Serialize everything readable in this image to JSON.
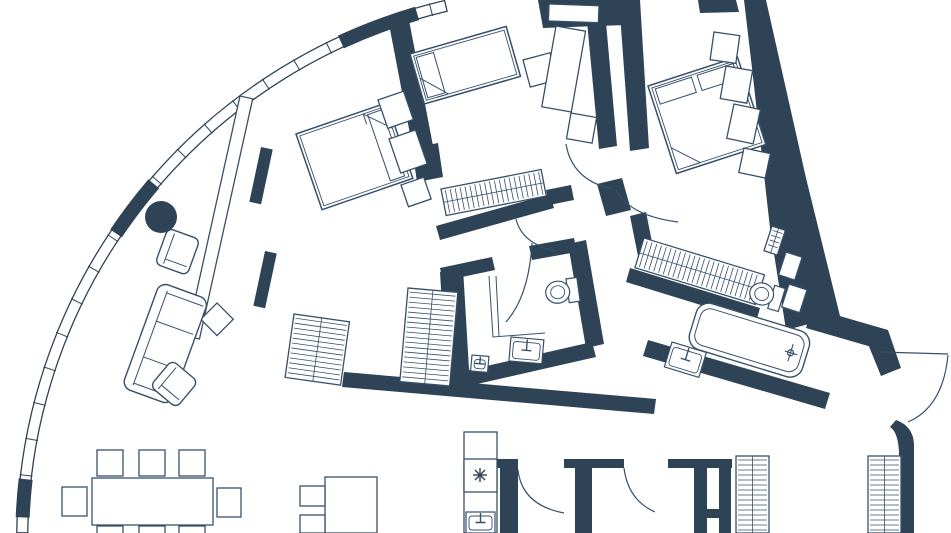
{
  "meta": {
    "title": "apartment-floor-plan",
    "canvas": {
      "width": 951,
      "height": 533
    },
    "colors": {
      "wall": "#2e4356",
      "line": "#37506a",
      "bg": "#ffffff"
    }
  },
  "floor_plan": {
    "window_wall": {
      "cx": 571.2,
      "cy": 540.4,
      "r_outer": 554.5,
      "r_inner": 543.5,
      "theta_start": -179.2,
      "theta_end": -103.2,
      "tick_step": 3.8,
      "solid_segments": [
        [
          -177.6,
          -173.6
        ],
        [
          -146.0,
          -139.5
        ],
        [
          -114.8,
          -106.3
        ]
      ],
      "column": {
        "cx": 161,
        "cy": 217,
        "r": 16
      }
    },
    "walls": [
      {
        "name": "wall-entry-top",
        "points": "538,0 622,0 626,25 543,28"
      },
      {
        "name": "wall-entry-top-2",
        "points": "698,0 736,0 739,12 700,13"
      },
      {
        "name": "wall-divider-left",
        "points": "389,24 409,20 438,172 418,176"
      },
      {
        "name": "wall-divider-left-foot",
        "points": "412,148 438,143 443,177 417,182"
      },
      {
        "name": "wall-divider-right",
        "points": "585,0 604,0 617,146 599,149"
      },
      {
        "name": "wall-hall-junction",
        "points": "597,184 622,178 631,210 606,216"
      },
      {
        "name": "wall-centerroom-south",
        "points": "436,226 550,194 554,208 440,240"
      },
      {
        "name": "wall-centerbath-top-left",
        "points": "440,268 492,257 495,270 443,281"
      },
      {
        "name": "wall-centerbath-top-right",
        "points": "529,246 574,238 577,252 532,260"
      },
      {
        "name": "wall-centerbath-stub",
        "points": "546,190 571,185 574,200 549,205"
      },
      {
        "name": "wall-centerbath-left",
        "points": "440,272 463,268 470,386 447,389"
      },
      {
        "name": "wall-centerbath-right",
        "points": "568,244 586,240 604,344 586,348"
      },
      {
        "name": "wall-centerbath-bottom",
        "points": "460,372 592,342 596,357 464,387"
      },
      {
        "name": "wall-living-kitchen",
        "points": "344,372 656,399 654,414 342,387"
      },
      {
        "name": "wall-rightbath-bottom",
        "points": "648,340 830,393 825,409 643,356"
      },
      {
        "name": "wall-rightbath-left",
        "points": "630,216 646,212 656,262 640,266"
      },
      {
        "name": "wall-rightroom-wardrobe-base",
        "points": "630,268 760,308 756,322 626,282"
      },
      {
        "name": "wall-exterior-right",
        "points": "744,0 766,0 806,178 840,316 786,330 770,228 752,68"
      },
      {
        "name": "wall-bend",
        "points": "812,308 888,330 882,350 806,328"
      },
      {
        "name": "wall-step",
        "points": "868,344 888,330 901,368 881,376"
      },
      {
        "name": "wall-rightroom-left",
        "points": "619,0 640,0 649,148 630,151"
      }
    ],
    "wall_paths": [
      {
        "name": "wall-pier-a",
        "d": "M488,459 L518,459 L518,533 L500,533 L500,468 L488,468 Z"
      },
      {
        "name": "wall-pier-b",
        "d": "M564,459 L624,459 L624,468 L592,468 L592,533 L575,533 L575,468 L564,468 Z"
      },
      {
        "name": "wall-pier-c-top",
        "d": "M668,459 L732,459 L732,468 L668,468 Z"
      },
      {
        "name": "wall-pier-c-leg-left",
        "d": "M694,468 L707,468 L707,533 L694,533 Z"
      },
      {
        "name": "wall-pier-c-leg-right",
        "d": "M719,468 L731,468 L731,533 L719,533 Z"
      },
      {
        "name": "wall-pier-c-shelf",
        "d": "M694,509 L731,509 L731,518 L694,518 Z"
      },
      {
        "name": "wall-right-bottom",
        "d": "M896,420 Q913,426 914,444 L914,533 L899,533 L899,452 Q898,432 890,427 Z"
      }
    ],
    "solid_rects": [
      {
        "name": "radiator-1",
        "x": 261,
        "y": 147,
        "rot": 12,
        "w": 12,
        "h": 56
      },
      {
        "name": "radiator-2",
        "x": 265,
        "y": 251,
        "rot": 12,
        "w": 12,
        "h": 56
      }
    ],
    "partitions": [
      {
        "name": "partition-living",
        "x": 240,
        "y": 96,
        "rot": 12.5,
        "w": 13,
        "h": 246
      }
    ],
    "doors": [
      {
        "name": "door-arc-center-bedroom",
        "d": "M566,144 Q572,180 612,189"
      },
      {
        "name": "door-arc-right-bedroom",
        "d": "M616,190 Q630,216 678,222"
      },
      {
        "name": "door-arc-centerbath-lobby",
        "d": "M516,219 Q522,244 556,251"
      },
      {
        "name": "door-arc-centerbath",
        "d": "M532,243 Q529,296 506,322"
      },
      {
        "name": "door-arc-corridor-1",
        "d": "M518,470 Q522,505 564,513"
      },
      {
        "name": "door-arc-corridor-2",
        "d": "M624,468 Q628,500 655,512"
      },
      {
        "name": "door-leaf-terrace",
        "d": "M880,352 L948,354"
      },
      {
        "name": "door-arc-terrace",
        "d": "M948,355 Q943,407 908,422"
      }
    ],
    "thin_lines": [
      {
        "name": "centerbath-screen-1",
        "d": "M489,276 L493,337 L545,333"
      },
      {
        "name": "centerbath-screen-2",
        "d": "M496,276 L499,336"
      },
      {
        "name": "desk-bottom-divider",
        "d": "M351,477 L351,533"
      }
    ],
    "wardrobes": [
      {
        "name": "wardrobe-left-low",
        "x": 294,
        "y": 314,
        "rot": 8,
        "w": 56,
        "h": 64,
        "tick": "h"
      },
      {
        "name": "wardrobe-column",
        "x": 408,
        "y": 288,
        "rot": 5,
        "w": 50,
        "h": 94,
        "tick": "h"
      },
      {
        "name": "wardrobe-center-room",
        "x": 441,
        "y": 189,
        "rot": -11,
        "w": 102,
        "h": 27,
        "tick": "v"
      },
      {
        "name": "wardrobe-right-room",
        "x": 644,
        "y": 238,
        "rot": 17,
        "w": 126,
        "h": 31,
        "tick": "v"
      },
      {
        "name": "wardrobe-hall-1",
        "x": 736,
        "y": 456,
        "rot": 0,
        "w": 33,
        "h": 77,
        "tick": "h"
      },
      {
        "name": "wardrobe-hall-2",
        "x": 868,
        "y": 456,
        "rot": 0,
        "w": 33,
        "h": 77,
        "tick": "h"
      },
      {
        "name": "shaft-hatch",
        "x": 772,
        "y": 226,
        "rot": 18,
        "w": 14,
        "h": 26,
        "tick": "h"
      }
    ],
    "beds": [
      {
        "name": "bed-left",
        "x": 296,
        "y": 134,
        "rot": -19,
        "w": 96,
        "h": 80,
        "pillow": "right",
        "fold": "tr"
      },
      {
        "name": "bed-center",
        "x": 410,
        "y": 54,
        "rot": -16,
        "w": 100,
        "h": 52,
        "pillow": "left",
        "fold": "bl"
      },
      {
        "name": "bed-right",
        "x": 648,
        "y": 86,
        "rot": -18,
        "w": 94,
        "h": 92,
        "pillow": "top",
        "fold": "bl"
      }
    ],
    "rects": [
      {
        "name": "nightstand-left-1",
        "x": 378,
        "y": 100,
        "rot": -19,
        "w": 27,
        "h": 30
      },
      {
        "name": "nightstand-left-2",
        "x": 389,
        "y": 139,
        "rot": -19,
        "w": 28,
        "h": 36
      },
      {
        "name": "nightstand-left-3",
        "x": 401,
        "y": 185,
        "rot": -19,
        "w": 24,
        "h": 23
      },
      {
        "name": "side-table-center",
        "x": 523,
        "y": 60,
        "rot": -15,
        "w": 28,
        "h": 28
      },
      {
        "name": "desk-center",
        "x": 556,
        "y": 26,
        "rot": 10,
        "w": 30,
        "h": 82
      },
      {
        "name": "desk-chair-center",
        "x": 571,
        "y": 113,
        "rot": 10,
        "w": 26,
        "h": 26
      },
      {
        "name": "nightstand-right-1",
        "x": 714,
        "y": 32,
        "rot": 8,
        "w": 26,
        "h": 28
      },
      {
        "name": "nightstand-right-2",
        "x": 726,
        "y": 66,
        "rot": 10,
        "w": 27,
        "h": 33
      },
      {
        "name": "nightstand-right-3",
        "x": 734,
        "y": 104,
        "rot": 12,
        "w": 27,
        "h": 35
      },
      {
        "name": "nightstand-right-4",
        "x": 744,
        "y": 148,
        "rot": 12,
        "w": 27,
        "h": 25
      },
      {
        "name": "coffee-table",
        "x": 217,
        "y": 303,
        "rot": 45,
        "w": 23,
        "h": 23
      },
      {
        "name": "dining-table",
        "x": 92,
        "y": 478,
        "rot": 0,
        "w": 121,
        "h": 47
      },
      {
        "name": "dining-chair-1",
        "x": 97,
        "y": 450,
        "rot": 0,
        "w": 26,
        "h": 26
      },
      {
        "name": "dining-chair-2",
        "x": 139,
        "y": 450,
        "rot": 0,
        "w": 26,
        "h": 26
      },
      {
        "name": "dining-chair-3",
        "x": 179,
        "y": 450,
        "rot": 0,
        "w": 26,
        "h": 26
      },
      {
        "name": "dining-chair-4",
        "x": 62,
        "y": 487,
        "rot": 0,
        "w": 25,
        "h": 29
      },
      {
        "name": "dining-chair-5",
        "x": 217,
        "y": 488,
        "rot": 0,
        "w": 24,
        "h": 29
      },
      {
        "name": "dining-chair-6",
        "x": 97,
        "y": 526,
        "rot": 0,
        "w": 26,
        "h": 20
      },
      {
        "name": "dining-chair-7",
        "x": 139,
        "y": 526,
        "rot": 0,
        "w": 26,
        "h": 20
      },
      {
        "name": "dining-chair-8",
        "x": 179,
        "y": 526,
        "rot": 0,
        "w": 26,
        "h": 20
      },
      {
        "name": "desk-bottom",
        "x": 325,
        "y": 477,
        "rot": 0,
        "w": 52,
        "h": 56
      },
      {
        "name": "desk-bottom-chair-1",
        "x": 300,
        "y": 486,
        "rot": 0,
        "w": 25,
        "h": 20
      },
      {
        "name": "desk-bottom-chair-2",
        "x": 300,
        "y": 515,
        "rot": 0,
        "w": 25,
        "h": 18
      },
      {
        "name": "kitchen-counter",
        "x": 464,
        "y": 432,
        "rot": 0,
        "w": 33,
        "h": 101
      },
      {
        "name": "fridge",
        "x": 464,
        "y": 459,
        "rot": 0,
        "w": 33,
        "h": 33
      },
      {
        "name": "niche-square-1",
        "x": 786,
        "y": 252,
        "rot": 18,
        "w": 17,
        "h": 24
      },
      {
        "name": "niche-square-2",
        "x": 789,
        "y": 284,
        "rot": 18,
        "w": 19,
        "h": 24
      },
      {
        "name": "entry-door-leaf",
        "x": 549,
        "y": 4,
        "rot": 2,
        "w": 50,
        "h": 17
      }
    ],
    "sofa": {
      "name": "sofa",
      "x": 160,
      "y": 282,
      "rot": 20,
      "w": 52,
      "h": 112
    },
    "armchairs": [
      {
        "name": "armchair-1",
        "x": 168,
        "y": 228,
        "rot": 20,
        "w": 34,
        "h": 38
      },
      {
        "name": "armchair-2",
        "x": 172,
        "y": 360,
        "rot": 40,
        "w": 34,
        "h": 34
      }
    ],
    "toilets": [
      {
        "name": "toilet-centerbath",
        "x": 544,
        "y": 281,
        "rot": -8
      },
      {
        "name": "toilet-rightbath",
        "x": 754,
        "y": 278,
        "rot": 17
      }
    ],
    "tub": {
      "name": "bathtub",
      "x": 700,
      "y": 300,
      "rot": 17,
      "w": 118,
      "h": 48
    },
    "sinks": [
      {
        "name": "sink-centerbath",
        "x": 511,
        "y": 337,
        "rot": 5,
        "w": 33,
        "h": 24
      },
      {
        "name": "sink-mini",
        "x": 472,
        "y": 355,
        "rot": 5,
        "w": 17,
        "h": 16
      },
      {
        "name": "sink-rightbath",
        "x": 672,
        "y": 342,
        "rot": 17,
        "w": 36,
        "h": 26
      },
      {
        "name": "sink-kitchen",
        "x": 466,
        "y": 512,
        "rot": 0,
        "w": 29,
        "h": 21
      }
    ],
    "snowflake": {
      "name": "fridge-snowflake",
      "x": 480,
      "y": 475,
      "r": 7
    }
  }
}
